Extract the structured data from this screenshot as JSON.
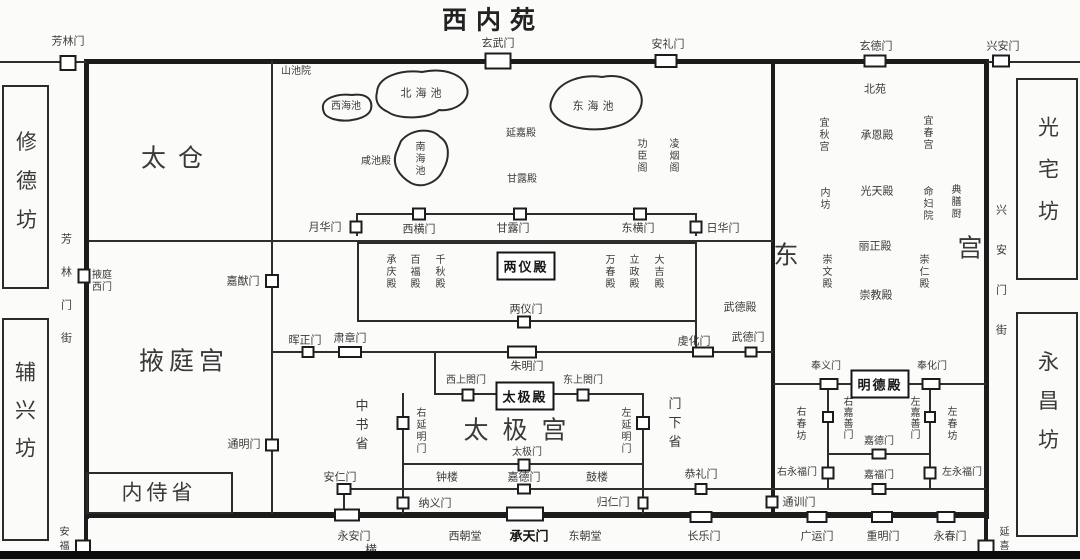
{
  "colors": {
    "wall": "#1c1c1c",
    "line": "#2e2e2e",
    "text": "#3a3a3a",
    "background": "#fbfbf9",
    "gate_fill": "#ffffff",
    "bottom_bar": "#0a0a0a"
  },
  "title": "西内苑",
  "north_wall": {
    "fanglinmen": "芳林门",
    "xuanwumen": "玄武门",
    "anlimen": "安礼门",
    "xuandemen": "玄德门",
    "xinganmen": "兴安门"
  },
  "west_side": {
    "xiudefang": "修德坊",
    "fuxingfang": "辅兴坊",
    "street": "芳林门街",
    "anfumen": "安福门",
    "yetingximen": "掖庭西门"
  },
  "east_side": {
    "guangzhaifang": "光宅坊",
    "yongchangfang": "永昌坊",
    "street": "兴安门街",
    "yanximen": "延喜门"
  },
  "inner_north": {
    "taicang": "太仓",
    "shanchiyuan": "山池院",
    "xihaichi": "西海池",
    "beihaichi": "北海池",
    "nanhaichi": "南海池",
    "donghaichi": "东海池",
    "xianchidian": "咸池殿",
    "yanjiadian": "延嘉殿",
    "ganludian": "甘露殿",
    "gongchenge": "功臣阁",
    "lingyange": "凌烟阁"
  },
  "yeting": {
    "yetinggong": "掖庭宫",
    "jiayoumen": "嘉猷门",
    "tongmingmen": "通明门",
    "neishisheng": "内侍省"
  },
  "liangyi": {
    "yuehuamen": "月华门",
    "xihengmen": "西横门",
    "ganlumen": "甘露门",
    "donghengmen": "东横门",
    "rihuamen": "日华门",
    "chengqingdian": "承庆殿",
    "baifudian": "百福殿",
    "qianqiudian": "千秋殿",
    "liangyidian": "两仪殿",
    "wanchundian": "万春殿",
    "lizhengdian": "立政殿",
    "dajidian": "大吉殿",
    "liangyimen": "两仪门"
  },
  "mid_band": {
    "huizhengmen": "晖正门",
    "suzhangmen": "肃章门",
    "zhumingmen": "朱明门",
    "qianhuamen": "虔化门",
    "wudemen": "武德门",
    "wudedian": "武德殿"
  },
  "taiji": {
    "xishanggemen": "西上閤门",
    "taijidian": "太极殿",
    "dongshanggemen": "东上閤门",
    "youyanmingmen": "右延明门",
    "zuoyanmingmen": "左延明门",
    "zhongshusheng": "中书省",
    "menxiasheng": "门下省",
    "taijigong": "太极宫",
    "taijimen": "太极门",
    "zhonglou": "钟楼",
    "jiademen": "嘉德门",
    "gulou": "鼓楼",
    "anrenmen": "安仁门",
    "nayimen": "纳义门",
    "guirenmen": "归仁门",
    "gonglimen": "恭礼门"
  },
  "south_wall": {
    "yonganmen": "永安门",
    "xichaotang": "西朝堂",
    "chengtianmen": "承天门",
    "dongchaotang": "东朝堂",
    "changlemen": "长乐门",
    "guangyunmen": "广运门",
    "chongmingmen": "重明门",
    "yongchunmen": "永春门",
    "hengjie": "横"
  },
  "east_palace": {
    "dong": "东",
    "gong": "宫",
    "beiyuan": "北苑",
    "yiqiugong": "宜秋宫",
    "chengendian": "承恩殿",
    "yichungong": "宜春宫",
    "neifang": "内坊",
    "guangtiandian": "光天殿",
    "mingfuyuan": "命妇院",
    "dianshanchu": "典膳厨",
    "chongwendian": "崇文殿",
    "lizhengdian": "丽正殿",
    "chongrendian": "崇仁殿",
    "chongjiaodian": "崇教殿",
    "fengyimen": "奉义门",
    "mingdedian": "明德殿",
    "fenghuamen": "奉化门",
    "youchunfang": "右春坊",
    "youjiashanmen": "右嘉善门",
    "zuojiashanmen": "左嘉善门",
    "zuochunfang": "左春坊",
    "jiademen": "嘉德门",
    "youyongfumen": "右永福门",
    "zuoyongfumen": "左永福门",
    "jiafumen": "嘉福门",
    "tongxunmen": "通训门"
  }
}
